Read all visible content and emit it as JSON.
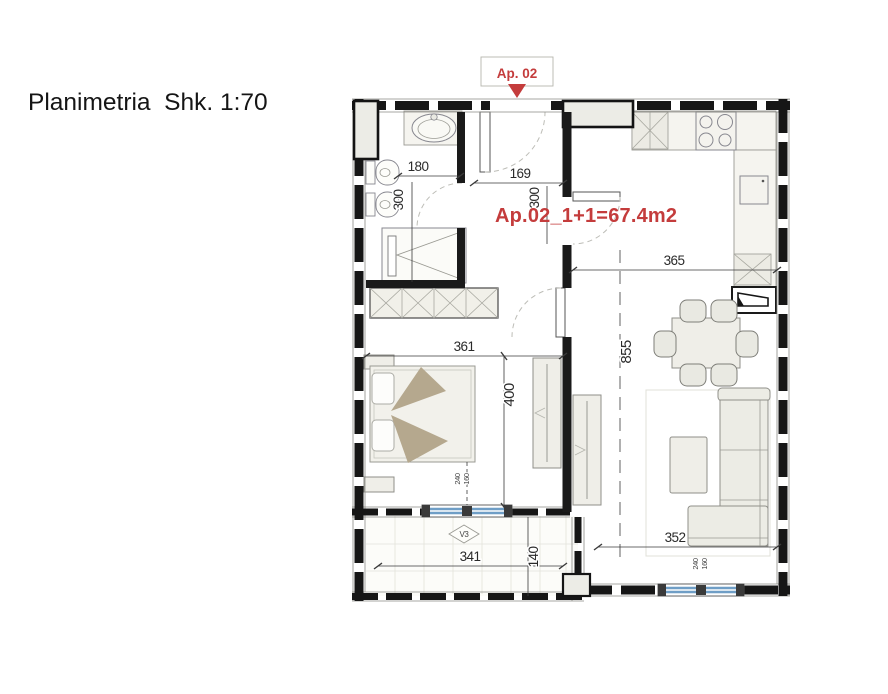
{
  "title": "Planimetria  Shk. 1:70",
  "apartment": {
    "tag": "Ap. 02",
    "area_label": "Ap.02_1+1=67.4m2"
  },
  "window_labels": {
    "balcony_door": "V3"
  },
  "dimensions": {
    "bathroom_width": "180",
    "bathroom_depth": "300",
    "entry_width": "169",
    "entry_depth": "300",
    "kitchen_width": "365",
    "living_length": "855",
    "bedroom_width": "361",
    "bedroom_depth": "400",
    "bedroom_window_height": "240",
    "bedroom_window_width": "160",
    "sofa_wall_width": "352",
    "living_window_width": "240",
    "living_window_height": "160",
    "balcony_width": "341",
    "balcony_depth": "140"
  },
  "colors": {
    "accent_red": "#c43c3c",
    "window_blue": "#6f9ec6",
    "wall_black": "#161616",
    "furniture_fill": "#efeee8",
    "blanket_tan": "#b5a88e"
  }
}
